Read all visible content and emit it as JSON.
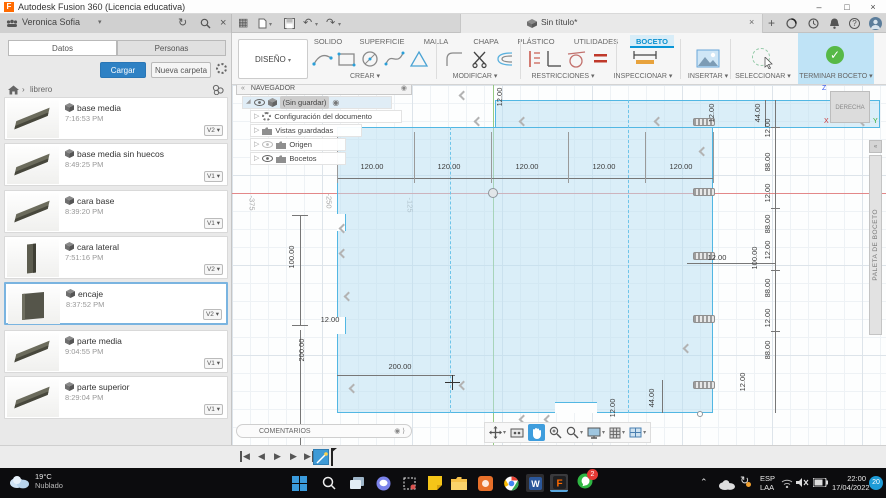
{
  "titlebar": {
    "app_title": "Autodesk Fusion 360 (Licencia educativa)"
  },
  "chrome": {
    "user_name": "Veronica Sofia",
    "doc_tab": "Sin título*"
  },
  "ribbon": {
    "design_menu": "DISEÑO",
    "tabs": [
      {
        "label": "SOLIDO"
      },
      {
        "label": "SUPERFICIE"
      },
      {
        "label": "MALLA"
      },
      {
        "label": "CHAPA"
      },
      {
        "label": "PLÁSTICO"
      },
      {
        "label": "UTILIDADES"
      },
      {
        "label": "BOCETO"
      }
    ],
    "groups": [
      {
        "label": "CREAR"
      },
      {
        "label": "MODIFICAR"
      },
      {
        "label": "RESTRICCIONES"
      },
      {
        "label": "INSPECCIONAR"
      },
      {
        "label": "INSERTAR"
      },
      {
        "label": "SELECCIONAR"
      },
      {
        "label": "TERMINAR BOCETO"
      }
    ]
  },
  "data_panel": {
    "tabs": [
      {
        "label": "Datos"
      },
      {
        "label": "Personas"
      }
    ],
    "upload_button": "Cargar",
    "new_folder_button": "Nueva carpeta",
    "breadcrumb": "librero",
    "files": [
      {
        "name": "base media",
        "time": "7:16:53 PM",
        "version": "V2"
      },
      {
        "name": "base media sin huecos",
        "time": "8:49:25 PM",
        "version": "V1"
      },
      {
        "name": "cara base",
        "time": "8:39:20 PM",
        "version": "V1"
      },
      {
        "name": "cara lateral",
        "time": "7:51:16 PM",
        "version": "V2"
      },
      {
        "name": "encaje",
        "time": "8:37:52 PM",
        "version": "V2"
      },
      {
        "name": "parte media",
        "time": "9:04:55 PM",
        "version": "V1"
      },
      {
        "name": "parte superior",
        "time": "8:29:04 PM",
        "version": "V1"
      }
    ]
  },
  "navegador": {
    "title": "NAVEGADOR",
    "root": "(Sin guardar)",
    "items": [
      {
        "label": "Configuración del documento"
      },
      {
        "label": "Vistas guardadas"
      },
      {
        "label": "Origen"
      },
      {
        "label": "Bocetos"
      }
    ]
  },
  "canvas": {
    "comments_label": "COMENTARIOS",
    "viewcube_label": "DERECHA",
    "viewcube_axes": {
      "x": "X",
      "y": "Y",
      "z": "Z"
    },
    "palette_label": "PALETA DE BOCETO",
    "grid_labels": [
      "-375",
      "-250",
      "-125"
    ],
    "dimensions": {
      "top": [
        "120.00",
        "120.00",
        "120.00",
        "120.00",
        "120.00"
      ],
      "right_stack": [
        "12.00",
        "88.00",
        "12.00",
        "88.00",
        "12.00",
        "88.00",
        "12.00",
        "88.00"
      ],
      "misc": {
        "d44_top": "44.00",
        "d12_top": "12.00",
        "d12_topmid": "12.00",
        "d100_right": "100.00",
        "d12_right_h": "12.00",
        "d12_right_low": "12.00",
        "d44_bottom": "44.00",
        "d12_bottom": "12.00",
        "d100_left": "100.00",
        "d200_left": "200.00",
        "d12_left": "12.00",
        "d200_bottom": "200.00"
      }
    }
  },
  "taskbar": {
    "weather_temp": "19°C",
    "weather_desc": "Nublado",
    "lang_line1": "ESP",
    "lang_line2": "LAA",
    "time": "22:00",
    "date": "17/04/2022",
    "whatsapp_badge": "2",
    "notification_badge": "20"
  }
}
